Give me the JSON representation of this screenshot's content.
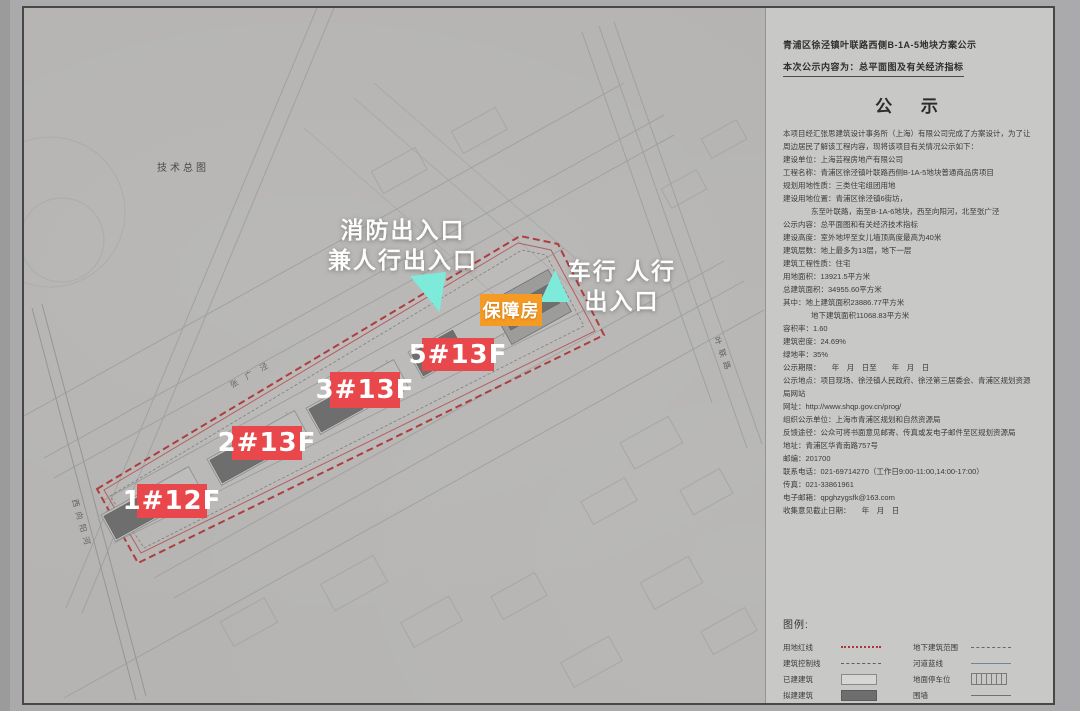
{
  "page": {
    "header": {
      "line1": "青浦区徐泾镇叶联路西侧B-1A-5地块方案公示",
      "line2": "本次公示内容为：总平面图及有关经济指标"
    },
    "notice": {
      "title": "公 示",
      "body_lines": [
        "本项目经汇张思建筑设计事务所（上海）有限公司完成了方案设计，为了让周边居民了解该工程内容，现将该项目有关情况公示如下：",
        "建设单位：上海芸程房地产有限公司",
        "工程名称：青浦区徐泾镇叶联路西侧B-1A-5地块普通商品房项目",
        "规划用地性质：三类住宅组团用地",
        "建设用地位置：青浦区徐泾镇6街坊，",
        "东至叶联路，南至B-1A-6地块，西至向阳河，北至张广泾",
        "公示内容：总平面图和有关经济技术指标",
        "建设高度：室外地坪至女儿墙顶高度最高为40米",
        "建筑层数：地上最多为13层，地下一层",
        "建筑工程性质：住宅",
        "用地面积：13921.5平方米",
        "总建筑面积：34955.60平方米",
        "其中：地上建筑面积23886.77平方米",
        "地下建筑面积11068.83平方米",
        "容积率：1.60",
        "建筑密度：24.69%",
        "绿地率：35%",
        "公示期限：　　年　月　日至　　年　月　日",
        "公示地点：项目现场、徐泾镇人民政府、徐泾第三居委会、青浦区规划资源局网站",
        "网址：http://www.shqp.gov.cn/prog/",
        "组织公示单位：上海市青浦区规划和自然资源局",
        "反馈途径：公众可将书面意见邮寄、传真或发电子邮件至区规划资源局",
        "地址：青浦区华青南路757号",
        "邮编：201700",
        "联系电话：021-69714270（工作日9:00-11:00,14:00-17:00）",
        "传真：021-33861961",
        "电子邮箱：qpghzygsfk@163.com",
        "收集意见截止日期：　　年　月　日"
      ]
    },
    "legend": {
      "title": "图例:",
      "items_left": [
        {
          "label": "用地红线",
          "symbol": "red-dashed-line"
        },
        {
          "label": "建筑控制线",
          "symbol": "fine-dashed-line"
        },
        {
          "label": "已建建筑",
          "symbol": "existing-building"
        },
        {
          "label": "拟建建筑",
          "symbol": "proposed-building"
        }
      ],
      "items_right": [
        {
          "label": "地下建筑范围",
          "symbol": "underground-outline"
        },
        {
          "label": "河道蓝线",
          "symbol": "river-blue-line"
        },
        {
          "label": "地面停车位",
          "symbol": "surface-parking"
        },
        {
          "label": "围墙",
          "symbol": "wall-line"
        }
      ]
    }
  },
  "map": {
    "sheet_label": "技术总图",
    "road_labels": [
      "西向阳河",
      "张广泾",
      "叶联路"
    ],
    "building_labels": [
      "1#12F",
      "2#13F",
      "3#13F",
      "5#13F"
    ],
    "support_housing_label": "保障房",
    "annotations": {
      "fire_exit_line1": "消防出入口",
      "fire_exit_line2": "兼人行出入口",
      "vehicle_exit_line1": "车行 人行",
      "vehicle_exit_line2": "出入口"
    },
    "colors": {
      "building_label_bg": "#e8474b",
      "support_housing_bg": "#f59a23",
      "arrow_color": "#7deada",
      "site_boundary_red": "#ae3d3f"
    }
  }
}
